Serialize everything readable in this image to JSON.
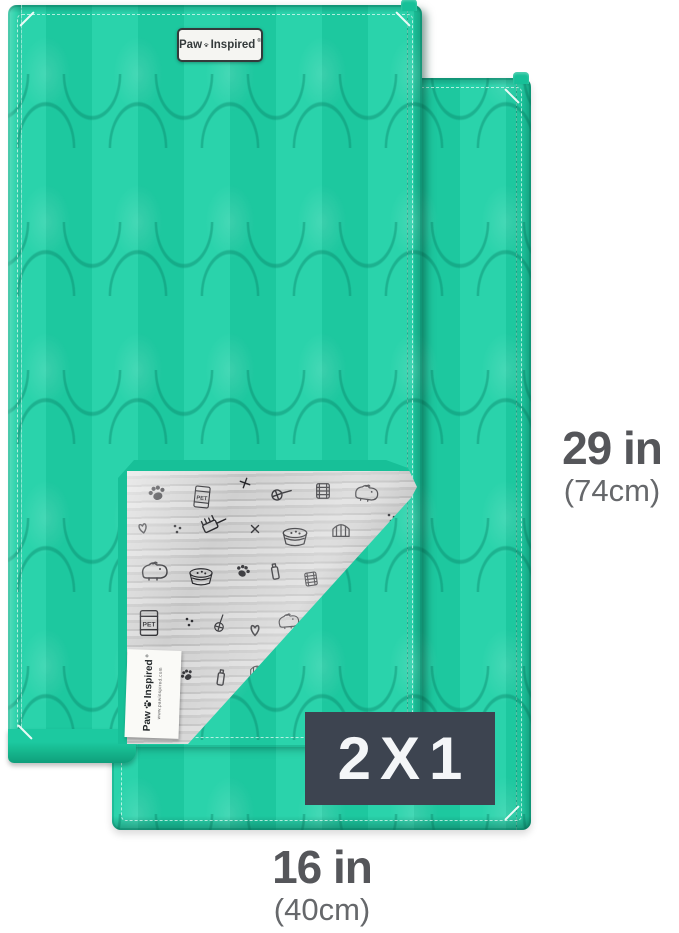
{
  "branding": {
    "word_paw": "Paw",
    "word_inspired": "Inspired",
    "registered_mark": "®",
    "label_website": "www.pawinspired.com"
  },
  "badge": {
    "label": "2X1"
  },
  "dimensions": {
    "height_inches": "29 in",
    "height_metric": "(74cm)",
    "width_inches": "16 in",
    "width_metric": "(40cm)"
  },
  "fabric_bag_text": "PET",
  "colors": {
    "teal": "#1fd1a7",
    "teal_binding": "#17c098",
    "badge_bg": "#3d4450",
    "badge_text": "#f4f6f8",
    "dim_primary": "#55565a",
    "dim_secondary": "#66686b",
    "fabric_gray": "#c9c9c9",
    "doodle_ink": "#26262a",
    "label_white": "#fafaf7"
  },
  "icons": {
    "paw_print": "paw-print-icon",
    "doodle_pattern": "pet-doodle-pattern"
  }
}
